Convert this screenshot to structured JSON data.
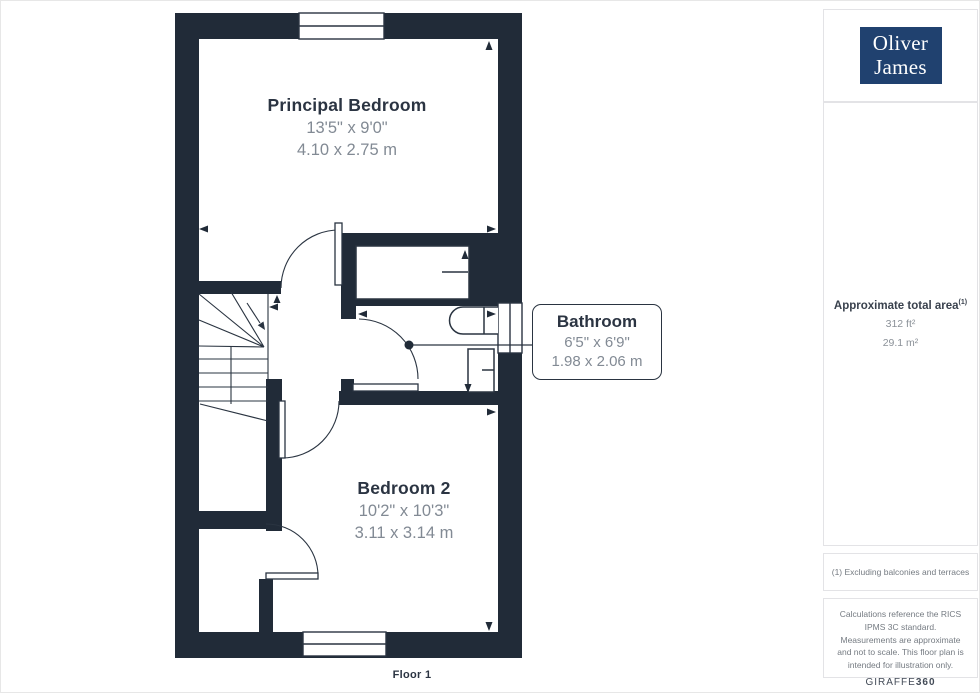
{
  "plan": {
    "floor_label": "Floor 1",
    "rooms": [
      {
        "name": "Principal Bedroom",
        "imperial": "13'5\" x 9'0\"",
        "metric": "4.10 x 2.75 m"
      },
      {
        "name": "Bathroom",
        "imperial": "6'5\" x 6'9\"",
        "metric": "1.98 x 2.06 m"
      },
      {
        "name": "Bedroom 2",
        "imperial": "10'2\" x 10'3\"",
        "metric": "3.11 x 3.14 m"
      }
    ]
  },
  "sidebar": {
    "logo": {
      "line1": "Oliver",
      "line2": "James"
    },
    "area": {
      "title": "Approximate total area",
      "superscript": "(1)",
      "imperial": "312 ft²",
      "metric": "29.1 m²"
    },
    "footnote": "(1) Excluding balconies and terraces",
    "disclaimer": "Calculations reference the RICS IPMS 3C standard. Measurements are approximate and not to scale. This floor plan is intended for illustration only.",
    "brand": {
      "name": "GIRAFFE",
      "suffix": "360"
    }
  },
  "colors": {
    "wall": "#212B38",
    "line": "#2A3441",
    "label_dark": "#2B3442",
    "label_gray": "#828A94",
    "logo_bg": "#20416F",
    "logo_text": "#FFFFFF",
    "border_gray": "#E3E3E6"
  }
}
